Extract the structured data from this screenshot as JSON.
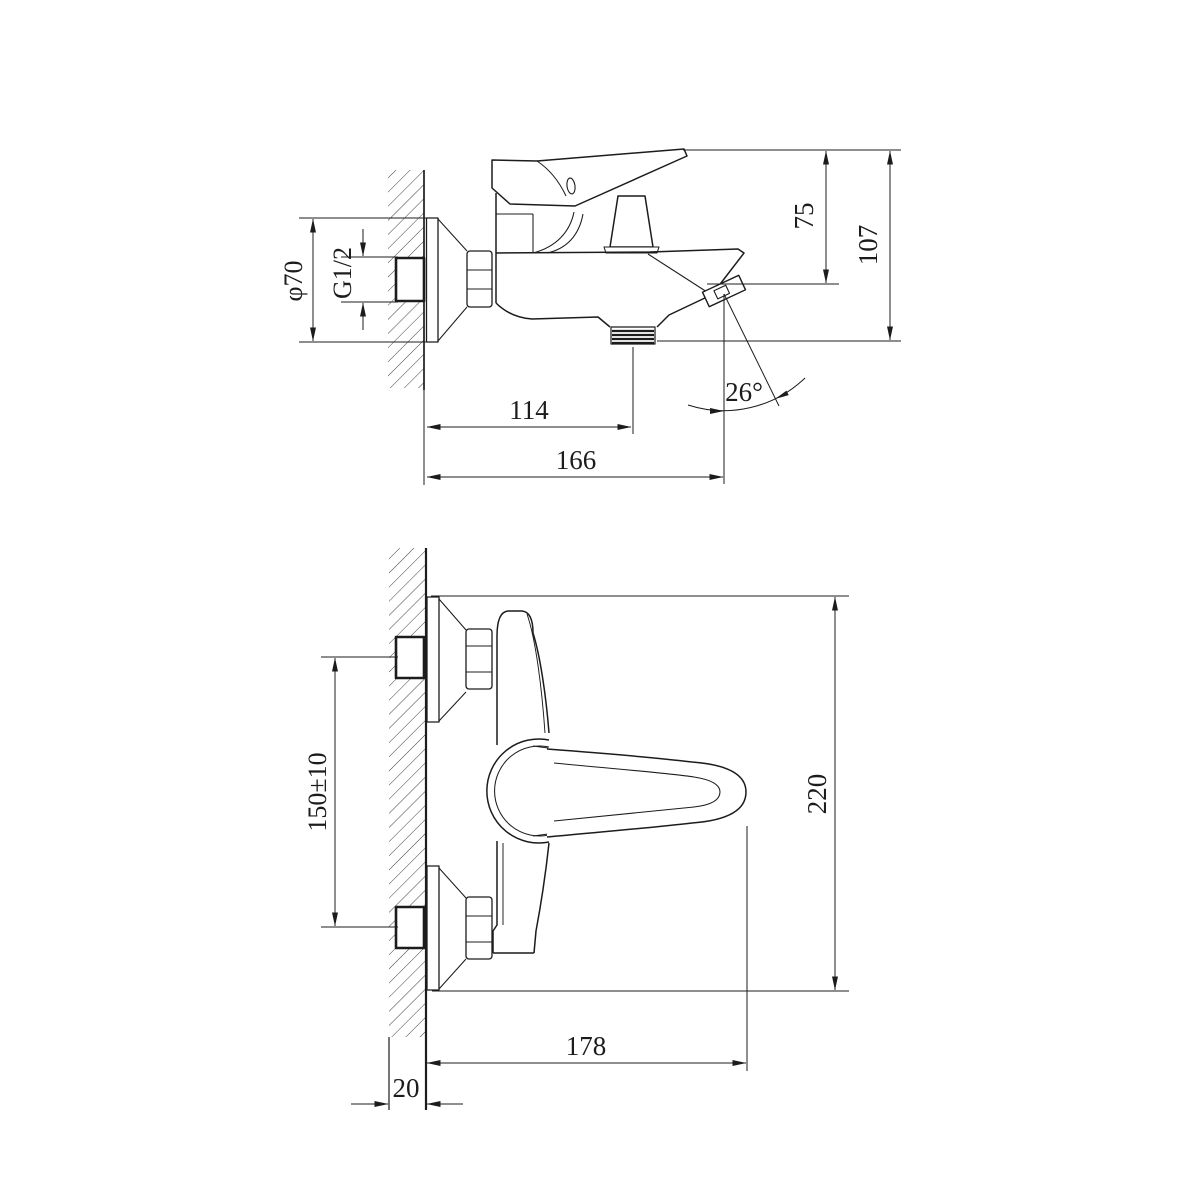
{
  "drawing": {
    "colors": {
      "line": "#1c1c1c",
      "background": "#ffffff"
    },
    "side": {
      "dims": {
        "flange_diameter": "φ70",
        "thread_size": "G1/2",
        "top_to_spout": "75",
        "top_to_outlet": "107",
        "wall_to_outlet": "114",
        "wall_to_tip": "166",
        "spout_angle": "26°"
      }
    },
    "front": {
      "dims": {
        "connection_centers": "150±10",
        "overall_height": "220",
        "overall_reach": "178",
        "wall_thickness": "20"
      }
    }
  }
}
